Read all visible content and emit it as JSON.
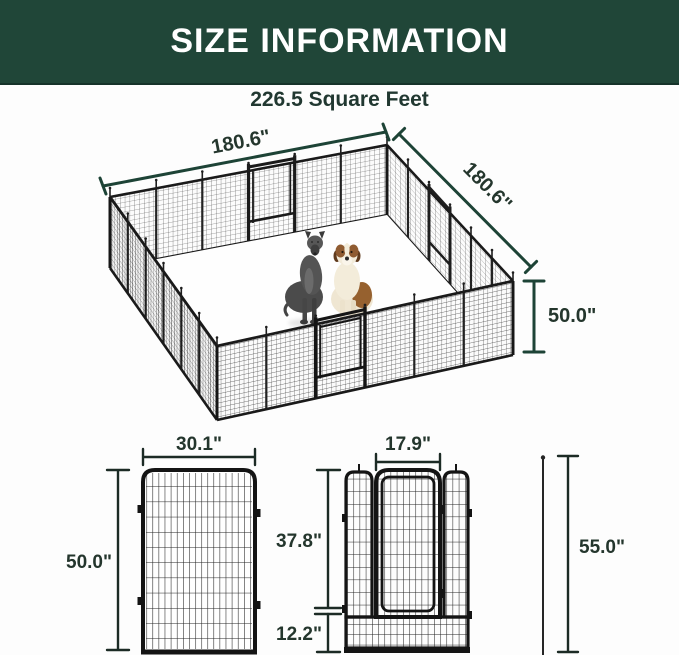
{
  "header": {
    "title": "SIZE INFORMATION"
  },
  "subtitle": "226.5 Square Feet",
  "iso": {
    "side1_label": "180.6\"",
    "side2_label": "180.6\"",
    "height_label": "50.0\""
  },
  "panel": {
    "width_label": "30.1\"",
    "height_label": "50.0\""
  },
  "gate": {
    "door_width_label": "17.9\"",
    "door_height_label": "37.8\"",
    "bottom_height_label": "12.2\"",
    "stake_height_label": "55.0\""
  },
  "colors": {
    "header_bg": "#204638",
    "header_text": "#ffffff",
    "dimension_green": "#1d4336",
    "text_ink": "#24362d",
    "line_black": "#141414"
  }
}
